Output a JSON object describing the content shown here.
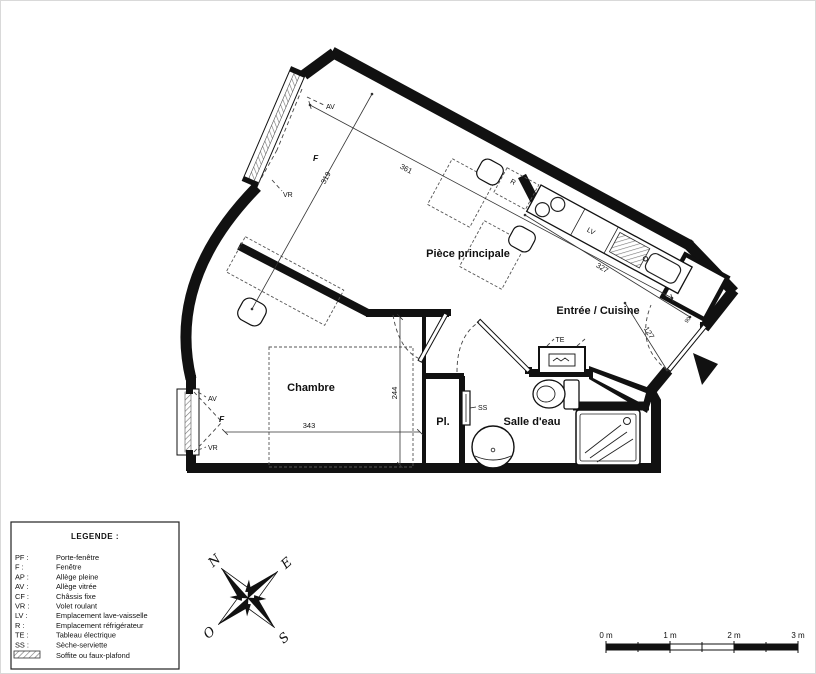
{
  "plan": {
    "rooms": {
      "main": "Pièce principale",
      "entry": "Entrée / Cuisine",
      "bedroom": "Chambre",
      "closet": "Pl.",
      "bathroom": "Salle d'eau"
    },
    "dims": {
      "main_width": "361",
      "main_depth": "319",
      "kitchen_run": "327",
      "bedroom_height": "244",
      "bedroom_width": "343",
      "entry": "127",
      "entry_door": "90"
    },
    "labels": {
      "av": "AV",
      "f": "F",
      "vr": "VR",
      "r": "R",
      "lv": "LV",
      "te": "TE",
      "ss": "SS"
    }
  },
  "legend": {
    "title": "LEGENDE :",
    "items": [
      {
        "abbr": "PF :",
        "label": "Porte-fenêtre"
      },
      {
        "abbr": "F :",
        "label": "Fenêtre"
      },
      {
        "abbr": "AP :",
        "label": "Allège pleine"
      },
      {
        "abbr": "AV :",
        "label": "Allège vitrée"
      },
      {
        "abbr": "CF :",
        "label": "Châssis fixe"
      },
      {
        "abbr": "VR :",
        "label": "Volet roulant"
      },
      {
        "abbr": "LV :",
        "label": "Emplacement lave-vaisselle"
      },
      {
        "abbr": "R :",
        "label": "Emplacement réfrigérateur"
      },
      {
        "abbr": "TE :",
        "label": "Tableau électrique"
      },
      {
        "abbr": "SS :",
        "label": "Sèche-serviette"
      },
      {
        "abbr": "",
        "label": "Soffite ou faux-plafond"
      }
    ]
  },
  "compass": {
    "north": "N",
    "east": "E",
    "south": "S",
    "west": "O"
  },
  "scale_bar": {
    "labels": [
      "0 m",
      "1 m",
      "2 m",
      "3 m"
    ]
  },
  "colors": {
    "wall": "#111111",
    "background": "#ffffff"
  }
}
